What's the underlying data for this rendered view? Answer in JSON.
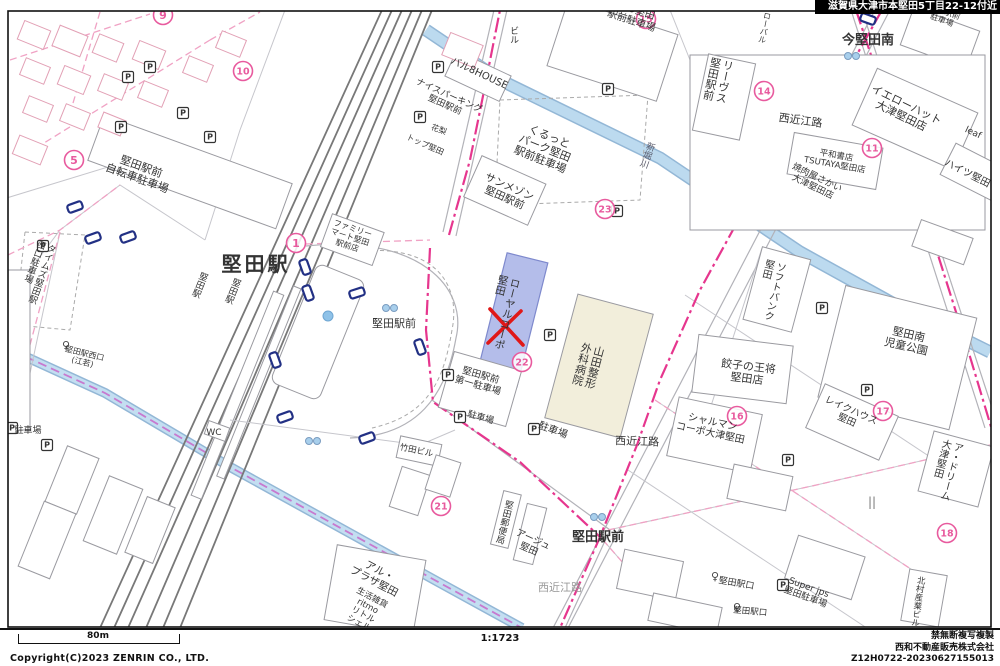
{
  "header": {
    "area_label": "滋賀県大津市本堅田5丁目22-12付近"
  },
  "footer": {
    "scale_bar_label": "80m",
    "scale_ratio": "1:1723",
    "copyright": "Copyright(C)2023 ZENRIN CO., LTD.",
    "notice": "禁無断複写複製",
    "company": "西和不動産販売株式会社",
    "code": "Z12H0722-20230627155013"
  },
  "map": {
    "target": {
      "name": "ローヤルコーポ堅田",
      "marker": "red-x",
      "x": 506,
      "y": 327,
      "highlight_color": "#b4bdea"
    },
    "station_name": "堅田駅",
    "accent_pink": "#e6368e",
    "marker_pink": "#e85a9e",
    "labels": [
      {
        "t": "堅田駅",
        "x": 256,
        "y": 271,
        "s": 20,
        "b": 1,
        "sp": 3
      },
      {
        "t": "堅田駅前",
        "x": 394,
        "y": 327,
        "s": 11
      },
      {
        "t": "今堅田南",
        "x": 868,
        "y": 44,
        "s": 13,
        "b": 1
      },
      {
        "t": "堅田駅前",
        "x": 598,
        "y": 541,
        "s": 13,
        "b": 1
      },
      {
        "t": "堅田駅前\n自転車駐車場",
        "x": 140,
        "y": 170,
        "s": 11,
        "r": 20
      },
      {
        "t": "くるっと\nパーク堅田\n駅前駐車場",
        "x": 548,
        "y": 140,
        "s": 11,
        "r": 22
      },
      {
        "t": "サンメゾン\n堅田駅前",
        "x": 508,
        "y": 190,
        "s": 10.5,
        "r": 24
      },
      {
        "t": "NPO堅田\n駅前駐車場",
        "x": 634,
        "y": 13,
        "s": 10,
        "r": 18
      },
      {
        "t": "バル8HOUSE",
        "x": 478,
        "y": 76,
        "s": 10,
        "r": 25
      },
      {
        "t": "ナイスパーキング\n堅田駅前",
        "x": 448,
        "y": 98,
        "s": 9,
        "r": 24
      },
      {
        "t": "花梨",
        "x": 438,
        "y": 132,
        "s": 8,
        "r": 20
      },
      {
        "t": "トップ堅田",
        "x": 424,
        "y": 147,
        "s": 8,
        "r": 24
      },
      {
        "t": "ビル",
        "x": 513,
        "y": 26,
        "s": 9,
        "v": 1
      },
      {
        "t": "ファミリー\nマート堅田\n駅前店",
        "x": 352,
        "y": 231,
        "s": 8,
        "r": 18
      },
      {
        "t": "リーヴス\n堅田駅前",
        "x": 729,
        "y": 60,
        "s": 11,
        "v": 1,
        "r": 12
      },
      {
        "t": "ローバル",
        "x": 768,
        "y": 12,
        "s": 8,
        "v": 1,
        "r": 12
      },
      {
        "t": "堅田駅前\n駐車場",
        "x": 944,
        "y": 14,
        "s": 8,
        "r": 20
      },
      {
        "t": "西近江路",
        "x": 800,
        "y": 124,
        "s": 11,
        "r": 8
      },
      {
        "t": "西近江路",
        "x": 637,
        "y": 445,
        "s": 11,
        "r": 2
      },
      {
        "t": "西近江路",
        "x": 560,
        "y": 591,
        "s": 11,
        "c": "#999"
      },
      {
        "t": "イエローハット\n大津堅田店",
        "x": 905,
        "y": 108,
        "s": 11,
        "r": 26
      },
      {
        "t": "平和書店\nTSUTAYA堅田店",
        "x": 836,
        "y": 158,
        "s": 8.5,
        "r": 10
      },
      {
        "t": "焼肉屋さかい\n大津堅田店",
        "x": 816,
        "y": 180,
        "s": 9,
        "r": 26
      },
      {
        "t": "ハイツ堅田",
        "x": 966,
        "y": 176,
        "s": 10,
        "r": 27
      },
      {
        "t": "leaf",
        "x": 972,
        "y": 135,
        "s": 9,
        "r": 25
      },
      {
        "t": "新堀川",
        "x": 651,
        "y": 142,
        "s": 9,
        "v": 1,
        "r": 20,
        "c": "#556"
      },
      {
        "t": "ソフトバンク\n堅田",
        "x": 781,
        "y": 262,
        "s": 10,
        "v": 1,
        "r": 14
      },
      {
        "t": "堅田南\n児童公園",
        "x": 908,
        "y": 338,
        "s": 11,
        "r": 13
      },
      {
        "t": "餃子の王将\n堅田店",
        "x": 748,
        "y": 370,
        "s": 11,
        "r": 7
      },
      {
        "t": "シャルマン\nコーポ大津堅田",
        "x": 712,
        "y": 425,
        "s": 10,
        "r": 12
      },
      {
        "t": "レイクハウス\n堅田",
        "x": 850,
        "y": 413,
        "s": 9.5,
        "r": 24
      },
      {
        "t": "ア・ドリーム\n大津堅田",
        "x": 958,
        "y": 442,
        "s": 10,
        "v": 1,
        "r": 15
      },
      {
        "t": "北村産業ビル",
        "x": 921,
        "y": 576,
        "s": 8.5,
        "v": 1,
        "r": 8
      },
      {
        "t": "山田整形\n外科病院",
        "x": 600,
        "y": 346,
        "s": 11,
        "v": 1,
        "r": 15
      },
      {
        "t": "ローヤルコーポ\n堅田",
        "x": 516,
        "y": 278,
        "s": 10.5,
        "v": 1,
        "r": 14
      },
      {
        "t": "堅田駅前\n第一駐車場",
        "x": 480,
        "y": 378,
        "s": 9.5,
        "r": 16
      },
      {
        "t": "駐車場",
        "x": 480,
        "y": 420,
        "s": 9,
        "r": 16
      },
      {
        "t": "駐車場",
        "x": 552,
        "y": 433,
        "s": 10,
        "r": 20
      },
      {
        "t": "駐車場",
        "x": 28,
        "y": 433,
        "s": 9
      },
      {
        "t": "堅田郵便局",
        "x": 509,
        "y": 500,
        "s": 9,
        "v": 1,
        "r": 14
      },
      {
        "t": "アージュ\n堅田",
        "x": 532,
        "y": 542,
        "s": 9.5,
        "r": 24
      },
      {
        "t": "竹田ビル",
        "x": 416,
        "y": 453,
        "s": 8.5,
        "r": 12
      },
      {
        "t": "WC",
        "x": 214,
        "y": 435,
        "s": 9
      },
      {
        "t": "アル・\nプラザ堅田",
        "x": 378,
        "y": 574,
        "s": 10.5,
        "r": 28
      },
      {
        "t": "生活雑貨\nritmo\nリトル\nシェル",
        "x": 371,
        "y": 600,
        "s": 8.5,
        "r": 28
      },
      {
        "t": "タイムズ堅田駅\n西口駐車場",
        "x": 52,
        "y": 244,
        "s": 9,
        "v": 1,
        "r": 20
      },
      {
        "t": "堅田駅",
        "x": 204,
        "y": 272,
        "s": 9,
        "v": 1,
        "r": 22
      },
      {
        "t": "堅田駅",
        "x": 237,
        "y": 278,
        "s": 9,
        "v": 1,
        "r": 22
      },
      {
        "t": "堅田駅西口\n(江若)",
        "x": 84,
        "y": 356,
        "s": 8,
        "r": 14
      },
      {
        "t": "堅田駅口",
        "x": 736,
        "y": 586,
        "s": 9,
        "r": 10
      },
      {
        "t": "堅田駅口",
        "x": 750,
        "y": 614,
        "s": 8.5,
        "r": 5
      },
      {
        "t": "Super jps\n堅田駐車場",
        "x": 808,
        "y": 590,
        "s": 9,
        "r": 20
      },
      {
        "t": "||",
        "x": 872,
        "y": 506,
        "s": 12,
        "c": "#777"
      }
    ],
    "markers": [
      {
        "n": "1",
        "x": 296,
        "y": 243
      },
      {
        "n": "5",
        "x": 74,
        "y": 160
      },
      {
        "n": "9",
        "x": 163,
        "y": 15
      },
      {
        "n": "10",
        "x": 243,
        "y": 71
      },
      {
        "n": "11",
        "x": 872,
        "y": 148
      },
      {
        "n": "14",
        "x": 764,
        "y": 91
      },
      {
        "n": "15",
        "x": 646,
        "y": 19
      },
      {
        "n": "16",
        "x": 737,
        "y": 416
      },
      {
        "n": "17",
        "x": 883,
        "y": 411
      },
      {
        "n": "18",
        "x": 947,
        "y": 533
      },
      {
        "n": "21",
        "x": 441,
        "y": 506
      },
      {
        "n": "22",
        "x": 522,
        "y": 362
      },
      {
        "n": "23",
        "x": 605,
        "y": 209
      }
    ],
    "parking_icons": [
      [
        150,
        67
      ],
      [
        128,
        77
      ],
      [
        183,
        113
      ],
      [
        121,
        127
      ],
      [
        210,
        137
      ],
      [
        438,
        67
      ],
      [
        420,
        117
      ],
      [
        608,
        89
      ],
      [
        550,
        335
      ],
      [
        822,
        308
      ],
      [
        867,
        390
      ],
      [
        788,
        460
      ],
      [
        47,
        445
      ],
      [
        534,
        429
      ],
      [
        448,
        375
      ],
      [
        460,
        417
      ],
      [
        43,
        246
      ],
      [
        783,
        585
      ],
      [
        12,
        428
      ],
      [
        617,
        211
      ]
    ],
    "car_icons": [
      [
        305,
        267,
        70
      ],
      [
        308,
        293,
        70
      ],
      [
        357,
        293,
        -18
      ],
      [
        275,
        360,
        70
      ],
      [
        285,
        417,
        -20
      ],
      [
        420,
        347,
        70
      ],
      [
        367,
        438,
        -20
      ],
      [
        75,
        207,
        -20
      ],
      [
        93,
        238,
        -20
      ],
      [
        128,
        237,
        -20
      ],
      [
        868,
        19,
        20
      ]
    ],
    "bus_stop_icons": [
      [
        62,
        349
      ],
      [
        711,
        580
      ],
      [
        733,
        611
      ]
    ],
    "traffic_signal_icons": [
      [
        598,
        517
      ],
      [
        852,
        56
      ],
      [
        390,
        308
      ],
      [
        313,
        441
      ]
    ],
    "fountain": {
      "x": 328,
      "y": 316
    }
  }
}
